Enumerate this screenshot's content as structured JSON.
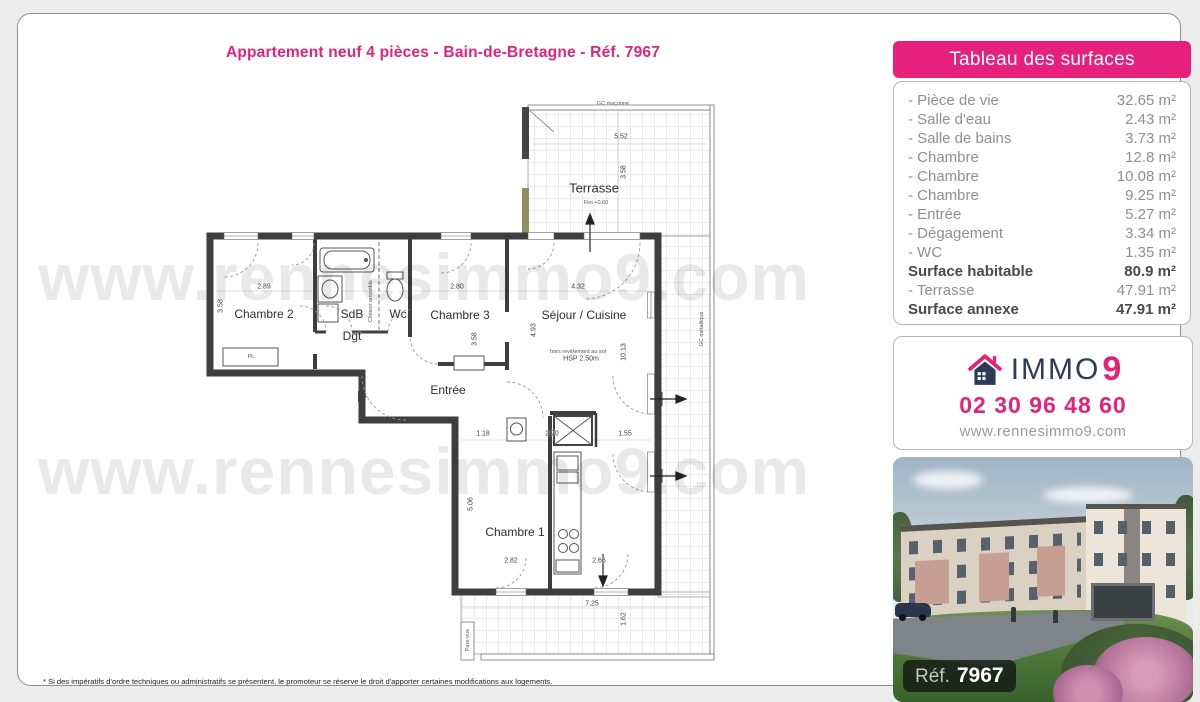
{
  "title": "Appartement neuf 4 pièces - Bain-de-Bretagne - Réf. 7967",
  "footnote": "* Si des impératifs d'ordre techniques ou administratifs se présentent, le promoteur se réserve le droit d'apporter certaines modifications aux logements.",
  "watermark": "www.rennesimmo9.com",
  "colors": {
    "pink": "#e6217b",
    "navy": "#2d3c55"
  },
  "surfaces": {
    "header": "Tableau des surfaces",
    "rows": [
      {
        "label": "- Pièce de vie",
        "value": "32.65 m²",
        "bold": false
      },
      {
        "label": "- Salle d'eau",
        "value": "2.43 m²",
        "bold": false
      },
      {
        "label": "- Salle de bains",
        "value": "3.73 m²",
        "bold": false
      },
      {
        "label": "- Chambre",
        "value": "12.8 m²",
        "bold": false
      },
      {
        "label": "- Chambre",
        "value": "10.08 m²",
        "bold": false
      },
      {
        "label": "- Chambre",
        "value": "9.25 m²",
        "bold": false
      },
      {
        "label": "- Entrée",
        "value": "5.27 m²",
        "bold": false
      },
      {
        "label": "- Dégagement",
        "value": "3.34 m²",
        "bold": false
      },
      {
        "label": "- WC",
        "value": "1.35 m²",
        "bold": false
      },
      {
        "label": "Surface habitable",
        "value": "80.9 m²",
        "bold": true
      },
      {
        "label": "- Terrasse",
        "value": "47.91 m²",
        "bold": false
      },
      {
        "label": "Surface annexe",
        "value": "47.91 m²",
        "bold": true
      }
    ]
  },
  "agency": {
    "brand": "IMMO",
    "brand_digit": "9",
    "phone": "02 30 96 48 60",
    "website": "www.rennesimmo9.com"
  },
  "photo": {
    "ref_label": "Réf.",
    "ref_value": "7967"
  },
  "plan": {
    "room_labels": [
      {
        "text": "Terrasse",
        "x": 396,
        "y": 86,
        "size": 13
      },
      {
        "text": "Chambre 2",
        "x": 66,
        "y": 212
      },
      {
        "text": "SdB",
        "x": 154,
        "y": 212
      },
      {
        "text": "Wc",
        "x": 200,
        "y": 212
      },
      {
        "text": "Dgt",
        "x": 154,
        "y": 234
      },
      {
        "text": "Chambre 3",
        "x": 262,
        "y": 213
      },
      {
        "text": "Séjour / Cuisine",
        "x": 386,
        "y": 213
      },
      {
        "text": "Entrée",
        "x": 250,
        "y": 288
      },
      {
        "text": "Chambre 1",
        "x": 317,
        "y": 430
      }
    ],
    "dim_labels": [
      {
        "text": "5.52",
        "x": 423,
        "y": 35
      },
      {
        "text": "3.58",
        "x": 426,
        "y": 70,
        "rot": true
      },
      {
        "text": "2.89",
        "x": 66,
        "y": 185
      },
      {
        "text": "3.58",
        "x": 23,
        "y": 204,
        "rot": true
      },
      {
        "text": "2.80",
        "x": 259,
        "y": 185
      },
      {
        "text": "3.58",
        "x": 277,
        "y": 237,
        "rot": true
      },
      {
        "text": "4.32",
        "x": 380,
        "y": 185
      },
      {
        "text": "4.93",
        "x": 336,
        "y": 228,
        "rot": true
      },
      {
        "text": "10.13",
        "x": 426,
        "y": 250,
        "rot": true
      },
      {
        "text": "HSP 2.50m",
        "x": 383,
        "y": 257
      },
      {
        "text": "1.18",
        "x": 285,
        "y": 332
      },
      {
        "text": "2.70",
        "x": 354,
        "y": 332
      },
      {
        "text": "1.55",
        "x": 427,
        "y": 332
      },
      {
        "text": "5.06",
        "x": 273,
        "y": 402,
        "rot": true
      },
      {
        "text": "2.82",
        "x": 313,
        "y": 459
      },
      {
        "text": "2.66",
        "x": 401,
        "y": 459
      },
      {
        "text": "7.25",
        "x": 394,
        "y": 502
      },
      {
        "text": "1.62",
        "x": 426,
        "y": 517,
        "rot": true
      }
    ],
    "tiny_labels": [
      {
        "text": "GC maçonné",
        "x": 415,
        "y": 2
      },
      {
        "text": "Fini +0.00",
        "x": 398,
        "y": 101
      },
      {
        "text": "hors revêtement au sol",
        "x": 380,
        "y": 250
      },
      {
        "text": "Cloison amovible",
        "x": 173,
        "y": 199,
        "rot": true
      },
      {
        "text": "GC métallique",
        "x": 504,
        "y": 227,
        "rot": true
      },
      {
        "text": "Pare-vue",
        "x": 270,
        "y": 538,
        "rot": true
      },
      {
        "text": "PL",
        "x": 53,
        "y": 255
      }
    ]
  }
}
